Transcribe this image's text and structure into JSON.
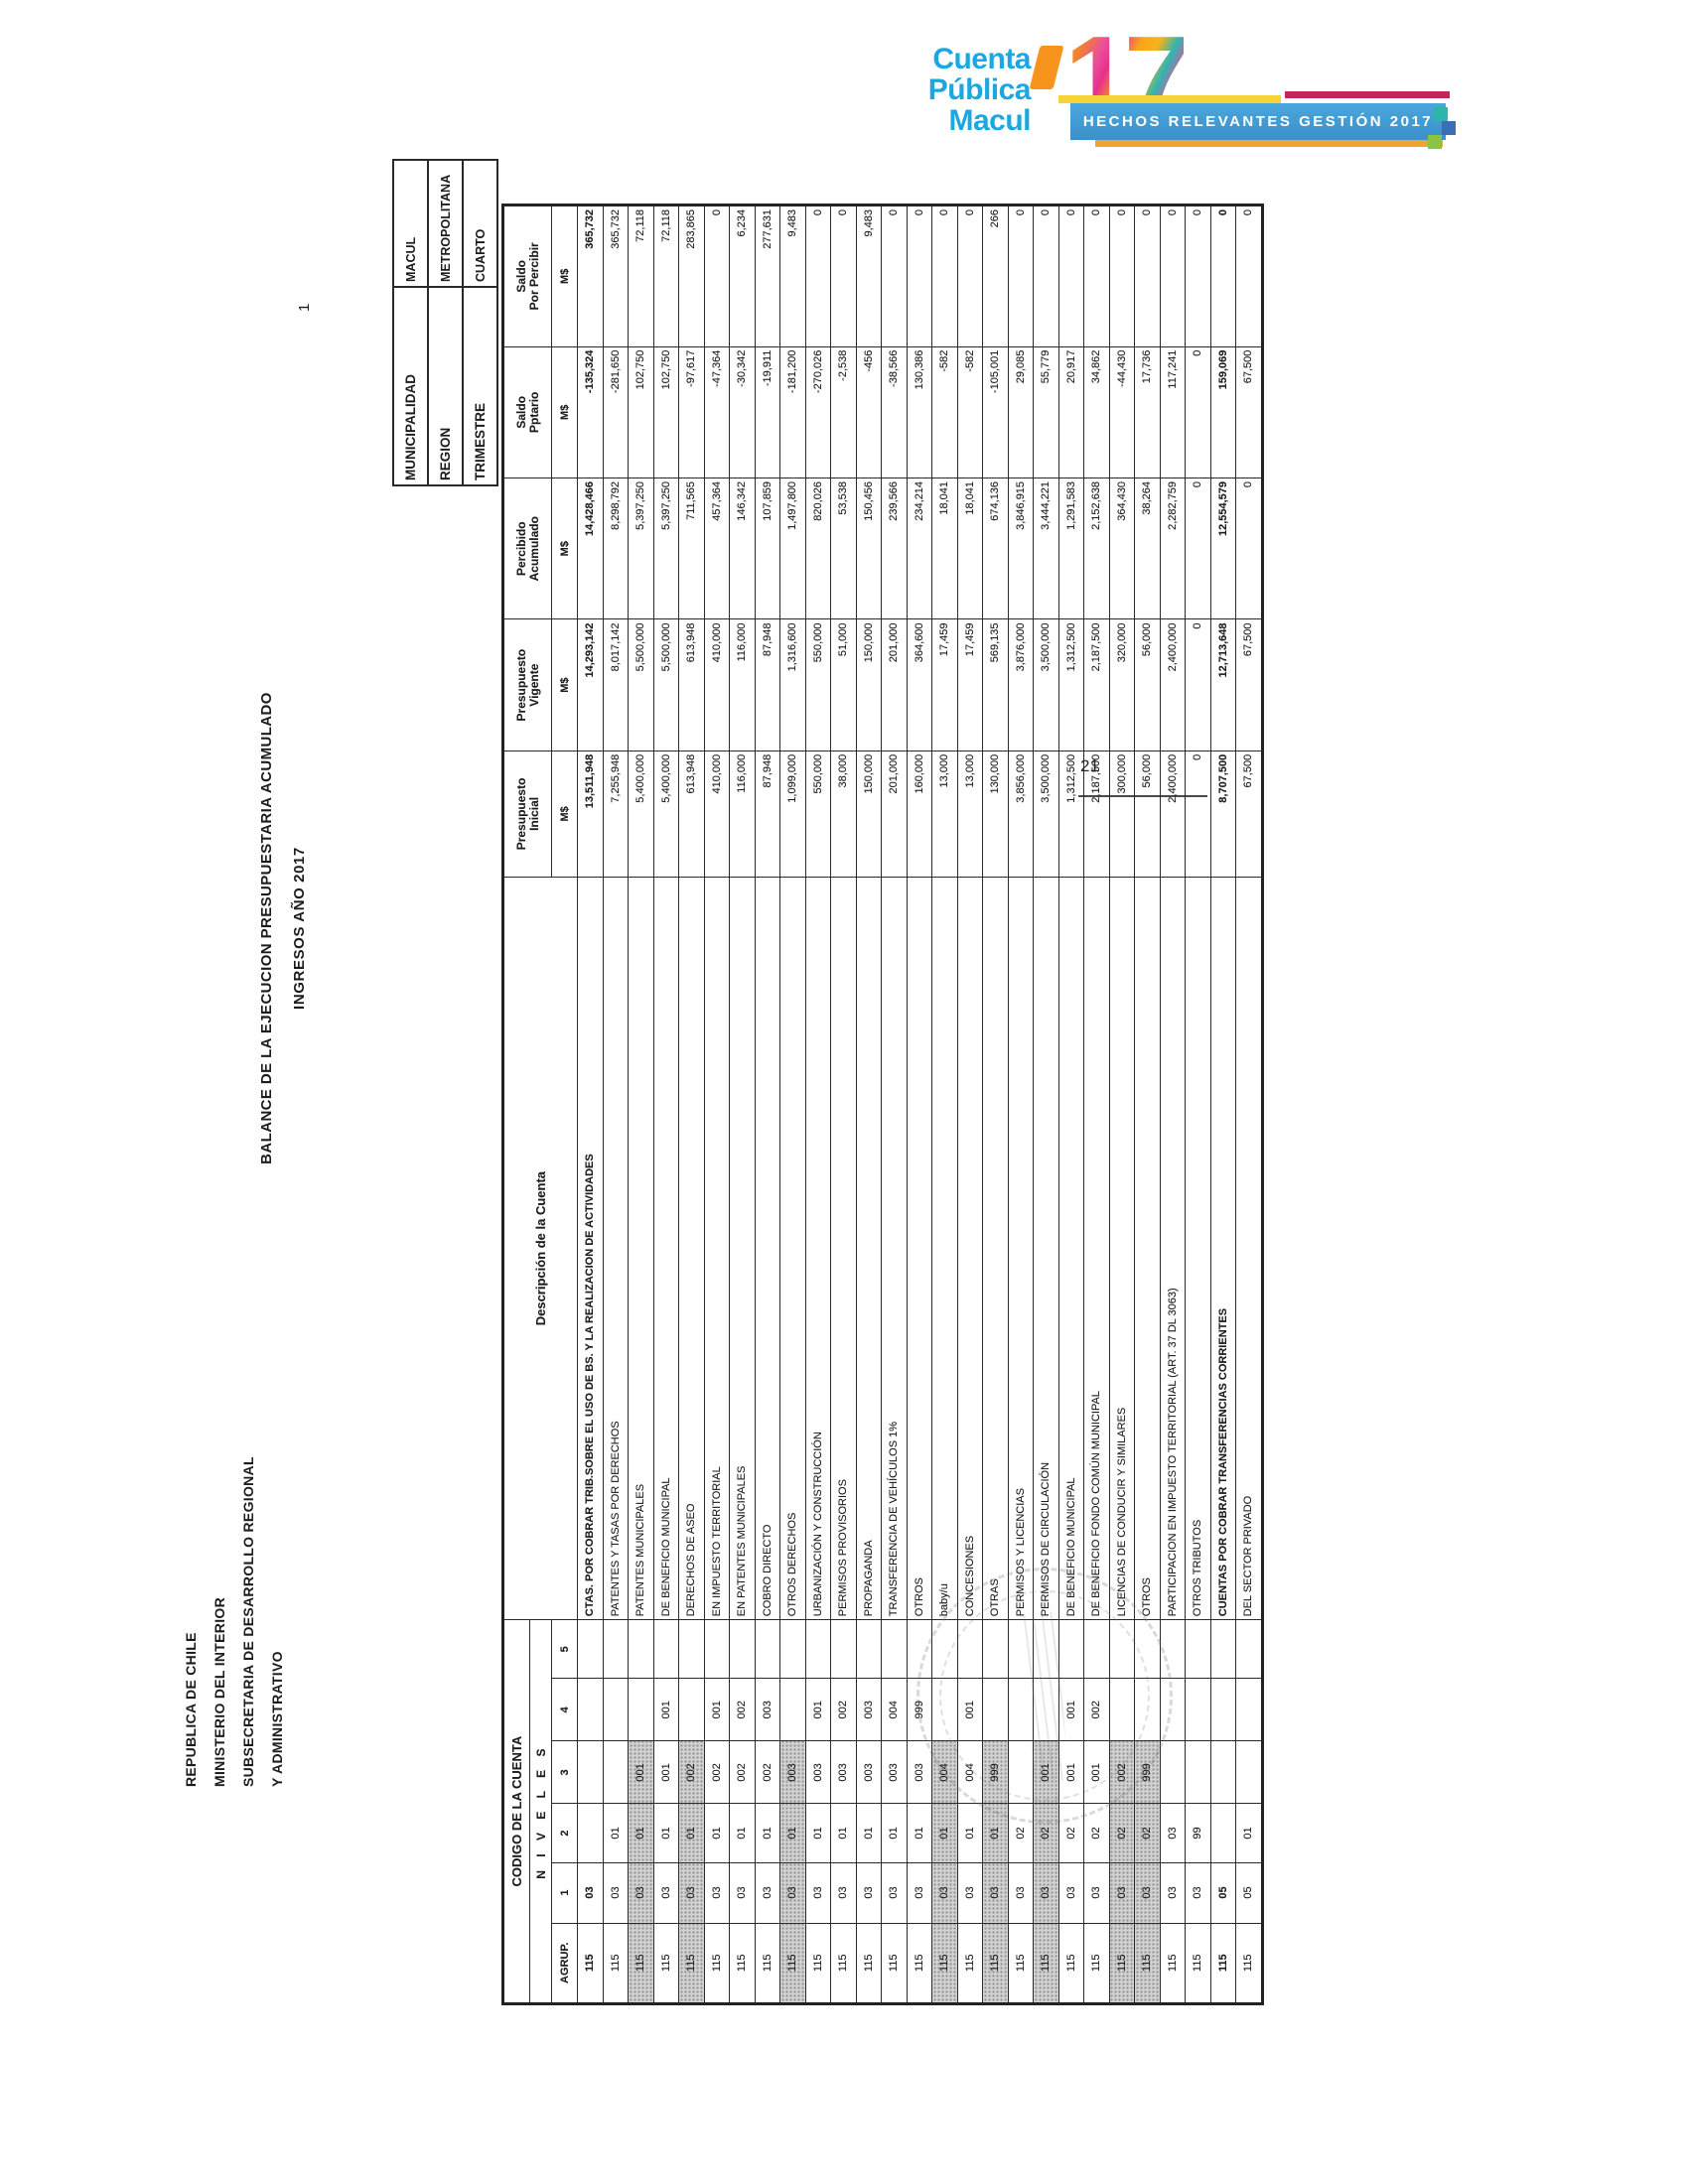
{
  "logo": {
    "line1": "Cuenta",
    "line2": "Pública",
    "line3": "Macul",
    "year": "17"
  },
  "banner": {
    "text": "HECHOS RELEVANTES GESTIÓN 2017"
  },
  "footer": {
    "page_number": "21"
  },
  "sheet": {
    "corner_page_marker": "1",
    "letterhead": {
      "line1": "REPUBLICA DE CHILE",
      "line2": "MINISTERIO DEL INTERIOR",
      "line3": "SUBSECRETARIA DE DESARROLLO REGIONAL",
      "line4": "Y ADMINISTRATIVO"
    },
    "title": {
      "line1": "BALANCE DE LA EJECUCION PRESUPUESTARIA ACUMULADO",
      "line2": "INGRESOS AÑO  2017"
    },
    "info_box": {
      "rows": [
        {
          "label": "MUNICIPALIDAD",
          "value": "MACUL"
        },
        {
          "label": "REGION",
          "value": "METROPOLITANA"
        },
        {
          "label": "TRIMESTRE",
          "value": "CUARTO"
        }
      ]
    },
    "table": {
      "header": {
        "codigo": "CODIGO DE LA CUENTA",
        "niveles": "N I V E L E S",
        "agrup": "AGRUP.",
        "levels": [
          "1",
          "2",
          "3",
          "4",
          "5"
        ],
        "descripcion": "Descripción de la Cuenta",
        "cols": [
          {
            "l1": "Presupuesto",
            "l2": "Inicial",
            "unit": "M$"
          },
          {
            "l1": "Presupuesto",
            "l2": "Vigente",
            "unit": "M$"
          },
          {
            "l1": "Percibido",
            "l2": "Acumulado",
            "unit": "M$"
          },
          {
            "l1": "Saldo",
            "l2": "Pptario",
            "unit": "M$"
          },
          {
            "l1": "Saldo",
            "l2": "Por Percibir",
            "unit": "M$"
          }
        ]
      },
      "rows": [
        {
          "codes": [
            "115",
            "03",
            "",
            "",
            "",
            ""
          ],
          "desc": "CTAS. POR COBRAR TRIB.SOBRE EL USO DE BS. Y LA REALIZACION DE ACTIVIDADES",
          "values": [
            "13,511,948",
            "14,293,142",
            "14,428,466",
            "-135,324",
            "365,732"
          ],
          "shaded": false,
          "bold": true
        },
        {
          "codes": [
            "115",
            "03",
            "01",
            "",
            "",
            ""
          ],
          "desc": "PATENTES Y TASAS POR DERECHOS",
          "values": [
            "7,255,948",
            "8,017,142",
            "8,298,792",
            "-281,650",
            "365,732"
          ],
          "shaded": false,
          "bold": false
        },
        {
          "codes": [
            "115",
            "03",
            "01",
            "001",
            "",
            ""
          ],
          "desc": "PATENTES MUNICIPALES",
          "values": [
            "5,400,000",
            "5,500,000",
            "5,397,250",
            "102,750",
            "72,118"
          ],
          "shaded": true,
          "bold": false
        },
        {
          "codes": [
            "115",
            "03",
            "01",
            "001",
            "001",
            ""
          ],
          "desc": "DE BENEFICIO MUNICIPAL",
          "values": [
            "5,400,000",
            "5,500,000",
            "5,397,250",
            "102,750",
            "72,118"
          ],
          "shaded": false,
          "bold": false
        },
        {
          "codes": [
            "115",
            "03",
            "01",
            "002",
            "",
            ""
          ],
          "desc": "DERECHOS DE ASEO",
          "values": [
            "613,948",
            "613,948",
            "711,565",
            "-97,617",
            "283,865"
          ],
          "shaded": true,
          "bold": false
        },
        {
          "codes": [
            "115",
            "03",
            "01",
            "002",
            "001",
            ""
          ],
          "desc": "EN IMPUESTO TERRITORIAL",
          "values": [
            "410,000",
            "410,000",
            "457,364",
            "-47,364",
            "0"
          ],
          "shaded": false,
          "bold": false
        },
        {
          "codes": [
            "115",
            "03",
            "01",
            "002",
            "002",
            ""
          ],
          "desc": "EN PATENTES MUNICIPALES",
          "values": [
            "116,000",
            "116,000",
            "146,342",
            "-30,342",
            "6,234"
          ],
          "shaded": false,
          "bold": false
        },
        {
          "codes": [
            "115",
            "03",
            "01",
            "002",
            "003",
            ""
          ],
          "desc": "COBRO DIRECTO",
          "values": [
            "87,948",
            "87,948",
            "107,859",
            "-19,911",
            "277,631"
          ],
          "shaded": false,
          "bold": false
        },
        {
          "codes": [
            "115",
            "03",
            "01",
            "003",
            "",
            ""
          ],
          "desc": "OTROS DERECHOS",
          "values": [
            "1,099,000",
            "1,316,600",
            "1,497,800",
            "-181,200",
            "9,483"
          ],
          "shaded": true,
          "bold": false
        },
        {
          "codes": [
            "115",
            "03",
            "01",
            "003",
            "001",
            ""
          ],
          "desc": "URBANIZACIÓN Y CONSTRUCCIÓN",
          "values": [
            "550,000",
            "550,000",
            "820,026",
            "-270,026",
            "0"
          ],
          "shaded": false,
          "bold": false
        },
        {
          "codes": [
            "115",
            "03",
            "01",
            "003",
            "002",
            ""
          ],
          "desc": "PERMISOS PROVISORIOS",
          "values": [
            "38,000",
            "51,000",
            "53,538",
            "-2,538",
            "0"
          ],
          "shaded": false,
          "bold": false
        },
        {
          "codes": [
            "115",
            "03",
            "01",
            "003",
            "003",
            ""
          ],
          "desc": "PROPAGANDA",
          "values": [
            "150,000",
            "150,000",
            "150,456",
            "-456",
            "9,483"
          ],
          "shaded": false,
          "bold": false
        },
        {
          "codes": [
            "115",
            "03",
            "01",
            "003",
            "004",
            ""
          ],
          "desc": "TRANSFERENCIA DE VEHÍCULOS  1%",
          "values": [
            "201,000",
            "201,000",
            "239,566",
            "-38,566",
            "0"
          ],
          "shaded": false,
          "bold": false
        },
        {
          "codes": [
            "115",
            "03",
            "01",
            "003",
            "999",
            ""
          ],
          "desc": "OTROS",
          "values": [
            "160,000",
            "364,600",
            "234,214",
            "130,386",
            "0"
          ],
          "shaded": false,
          "bold": false
        },
        {
          "codes": [
            "115",
            "03",
            "01",
            "004",
            "",
            ""
          ],
          "desc": "baby/u",
          "values": [
            "13,000",
            "17,459",
            "18,041",
            "-582",
            "0"
          ],
          "shaded": true,
          "bold": false
        },
        {
          "codes": [
            "115",
            "03",
            "01",
            "004",
            "001",
            ""
          ],
          "desc": "CONCESIONES",
          "values": [
            "13,000",
            "17,459",
            "18,041",
            "-582",
            "0"
          ],
          "shaded": false,
          "bold": false
        },
        {
          "codes": [
            "115",
            "03",
            "01",
            "999",
            "",
            ""
          ],
          "desc": "OTRAS",
          "values": [
            "130,000",
            "569,135",
            "674,136",
            "-105,001",
            "266"
          ],
          "shaded": true,
          "bold": false
        },
        {
          "codes": [
            "115",
            "03",
            "02",
            "",
            "",
            ""
          ],
          "desc": "PERMISOS Y LICENCIAS",
          "values": [
            "3,856,000",
            "3,876,000",
            "3,846,915",
            "29,085",
            "0"
          ],
          "shaded": false,
          "bold": false
        },
        {
          "codes": [
            "115",
            "03",
            "02",
            "001",
            "",
            ""
          ],
          "desc": "PERMISOS DE CIRCULACIÓN",
          "values": [
            "3,500,000",
            "3,500,000",
            "3,444,221",
            "55,779",
            "0"
          ],
          "shaded": true,
          "bold": false
        },
        {
          "codes": [
            "115",
            "03",
            "02",
            "001",
            "001",
            ""
          ],
          "desc": "DE BENEFICIO MUNICIPAL",
          "values": [
            "1,312,500",
            "1,312,500",
            "1,291,583",
            "20,917",
            "0"
          ],
          "shaded": false,
          "bold": false
        },
        {
          "codes": [
            "115",
            "03",
            "02",
            "001",
            "002",
            ""
          ],
          "desc": "DE BENEFICIO FONDO COMÚN MUNICIPAL",
          "values": [
            "2,187,500",
            "2,187,500",
            "2,152,638",
            "34,862",
            "0"
          ],
          "shaded": false,
          "bold": false
        },
        {
          "codes": [
            "115",
            "03",
            "02",
            "002",
            "",
            ""
          ],
          "desc": "LICENCIAS DE CONDUCIR Y SIMILARES",
          "values": [
            "300,000",
            "320,000",
            "364,430",
            "-44,430",
            "0"
          ],
          "shaded": true,
          "bold": false
        },
        {
          "codes": [
            "115",
            "03",
            "02",
            "999",
            "",
            ""
          ],
          "desc": "OTROS",
          "values": [
            "56,000",
            "56,000",
            "38,264",
            "17,736",
            "0"
          ],
          "shaded": true,
          "bold": false
        },
        {
          "codes": [
            "115",
            "03",
            "03",
            "",
            "",
            ""
          ],
          "desc": "PARTICIPACION EN IMPUESTO TERRITORIAL (ART. 37 DL 3063)",
          "values": [
            "2,400,000",
            "2,400,000",
            "2,282,759",
            "117,241",
            "0"
          ],
          "shaded": false,
          "bold": false
        },
        {
          "codes": [
            "115",
            "03",
            "99",
            "",
            "",
            ""
          ],
          "desc": "OTROS TRIBUTOS",
          "values": [
            "0",
            "0",
            "0",
            "0",
            "0"
          ],
          "shaded": false,
          "bold": false
        },
        {
          "codes": [
            "115",
            "05",
            "",
            "",
            "",
            ""
          ],
          "desc": "CUENTAS POR COBRAR TRANSFERENCIAS CORRIENTES",
          "values": [
            "8,707,500",
            "12,713,648",
            "12,554,579",
            "159,069",
            "0"
          ],
          "shaded": false,
          "bold": true
        },
        {
          "codes": [
            "115",
            "05",
            "01",
            "",
            "",
            ""
          ],
          "desc": "DEL SECTOR PRIVADO",
          "values": [
            "67,500",
            "67,500",
            "0",
            "67,500",
            "0"
          ],
          "shaded": false,
          "bold": false
        }
      ]
    }
  }
}
